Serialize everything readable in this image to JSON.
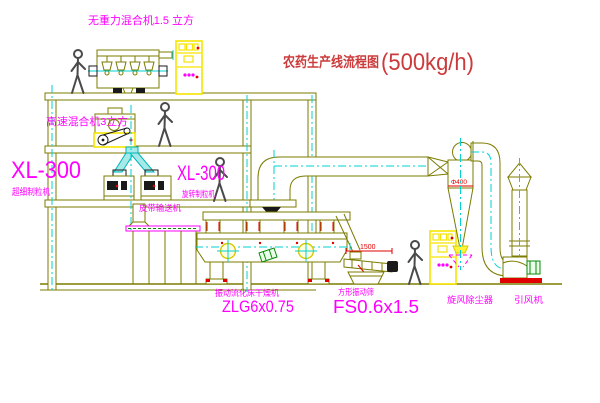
{
  "title": {
    "text": "农药生产线流程图",
    "capacity": "(500kg/h)",
    "color": "#cc3b3b"
  },
  "labels": {
    "gravity_mixer": "无重力混合机1.5 立方",
    "high_speed_mixer": "高速混合机3立方",
    "granulator_left_model": "XL-300",
    "granulator_left_name": "超细制粒机",
    "granulator_mid_model": "XL-300",
    "granulator_mid_name": "旋转制粒机",
    "belt_conveyor": "皮带输送机",
    "dryer_name": "振动流化床干燥机",
    "dryer_model": "ZLG6x0.75",
    "sieve_name": "方形振动筛",
    "sieve_model": "FS0.6x1.5",
    "cyclone_name": "旋风除尘器",
    "fan_name": "引风机"
  },
  "dimensions": {
    "sieve_length": "1500",
    "cyclone_diameter": "Φ400"
  },
  "colors": {
    "machine_line": "#7b7b00",
    "centerline_cyan": "#00d2d2",
    "label_magenta": "#ff00ff",
    "cabinet_yellow": "#f5e400",
    "accent_red": "#e00000",
    "title_red": "#cc3b3b",
    "motor_green": "#0a8a0a",
    "background": "#ffffff"
  }
}
